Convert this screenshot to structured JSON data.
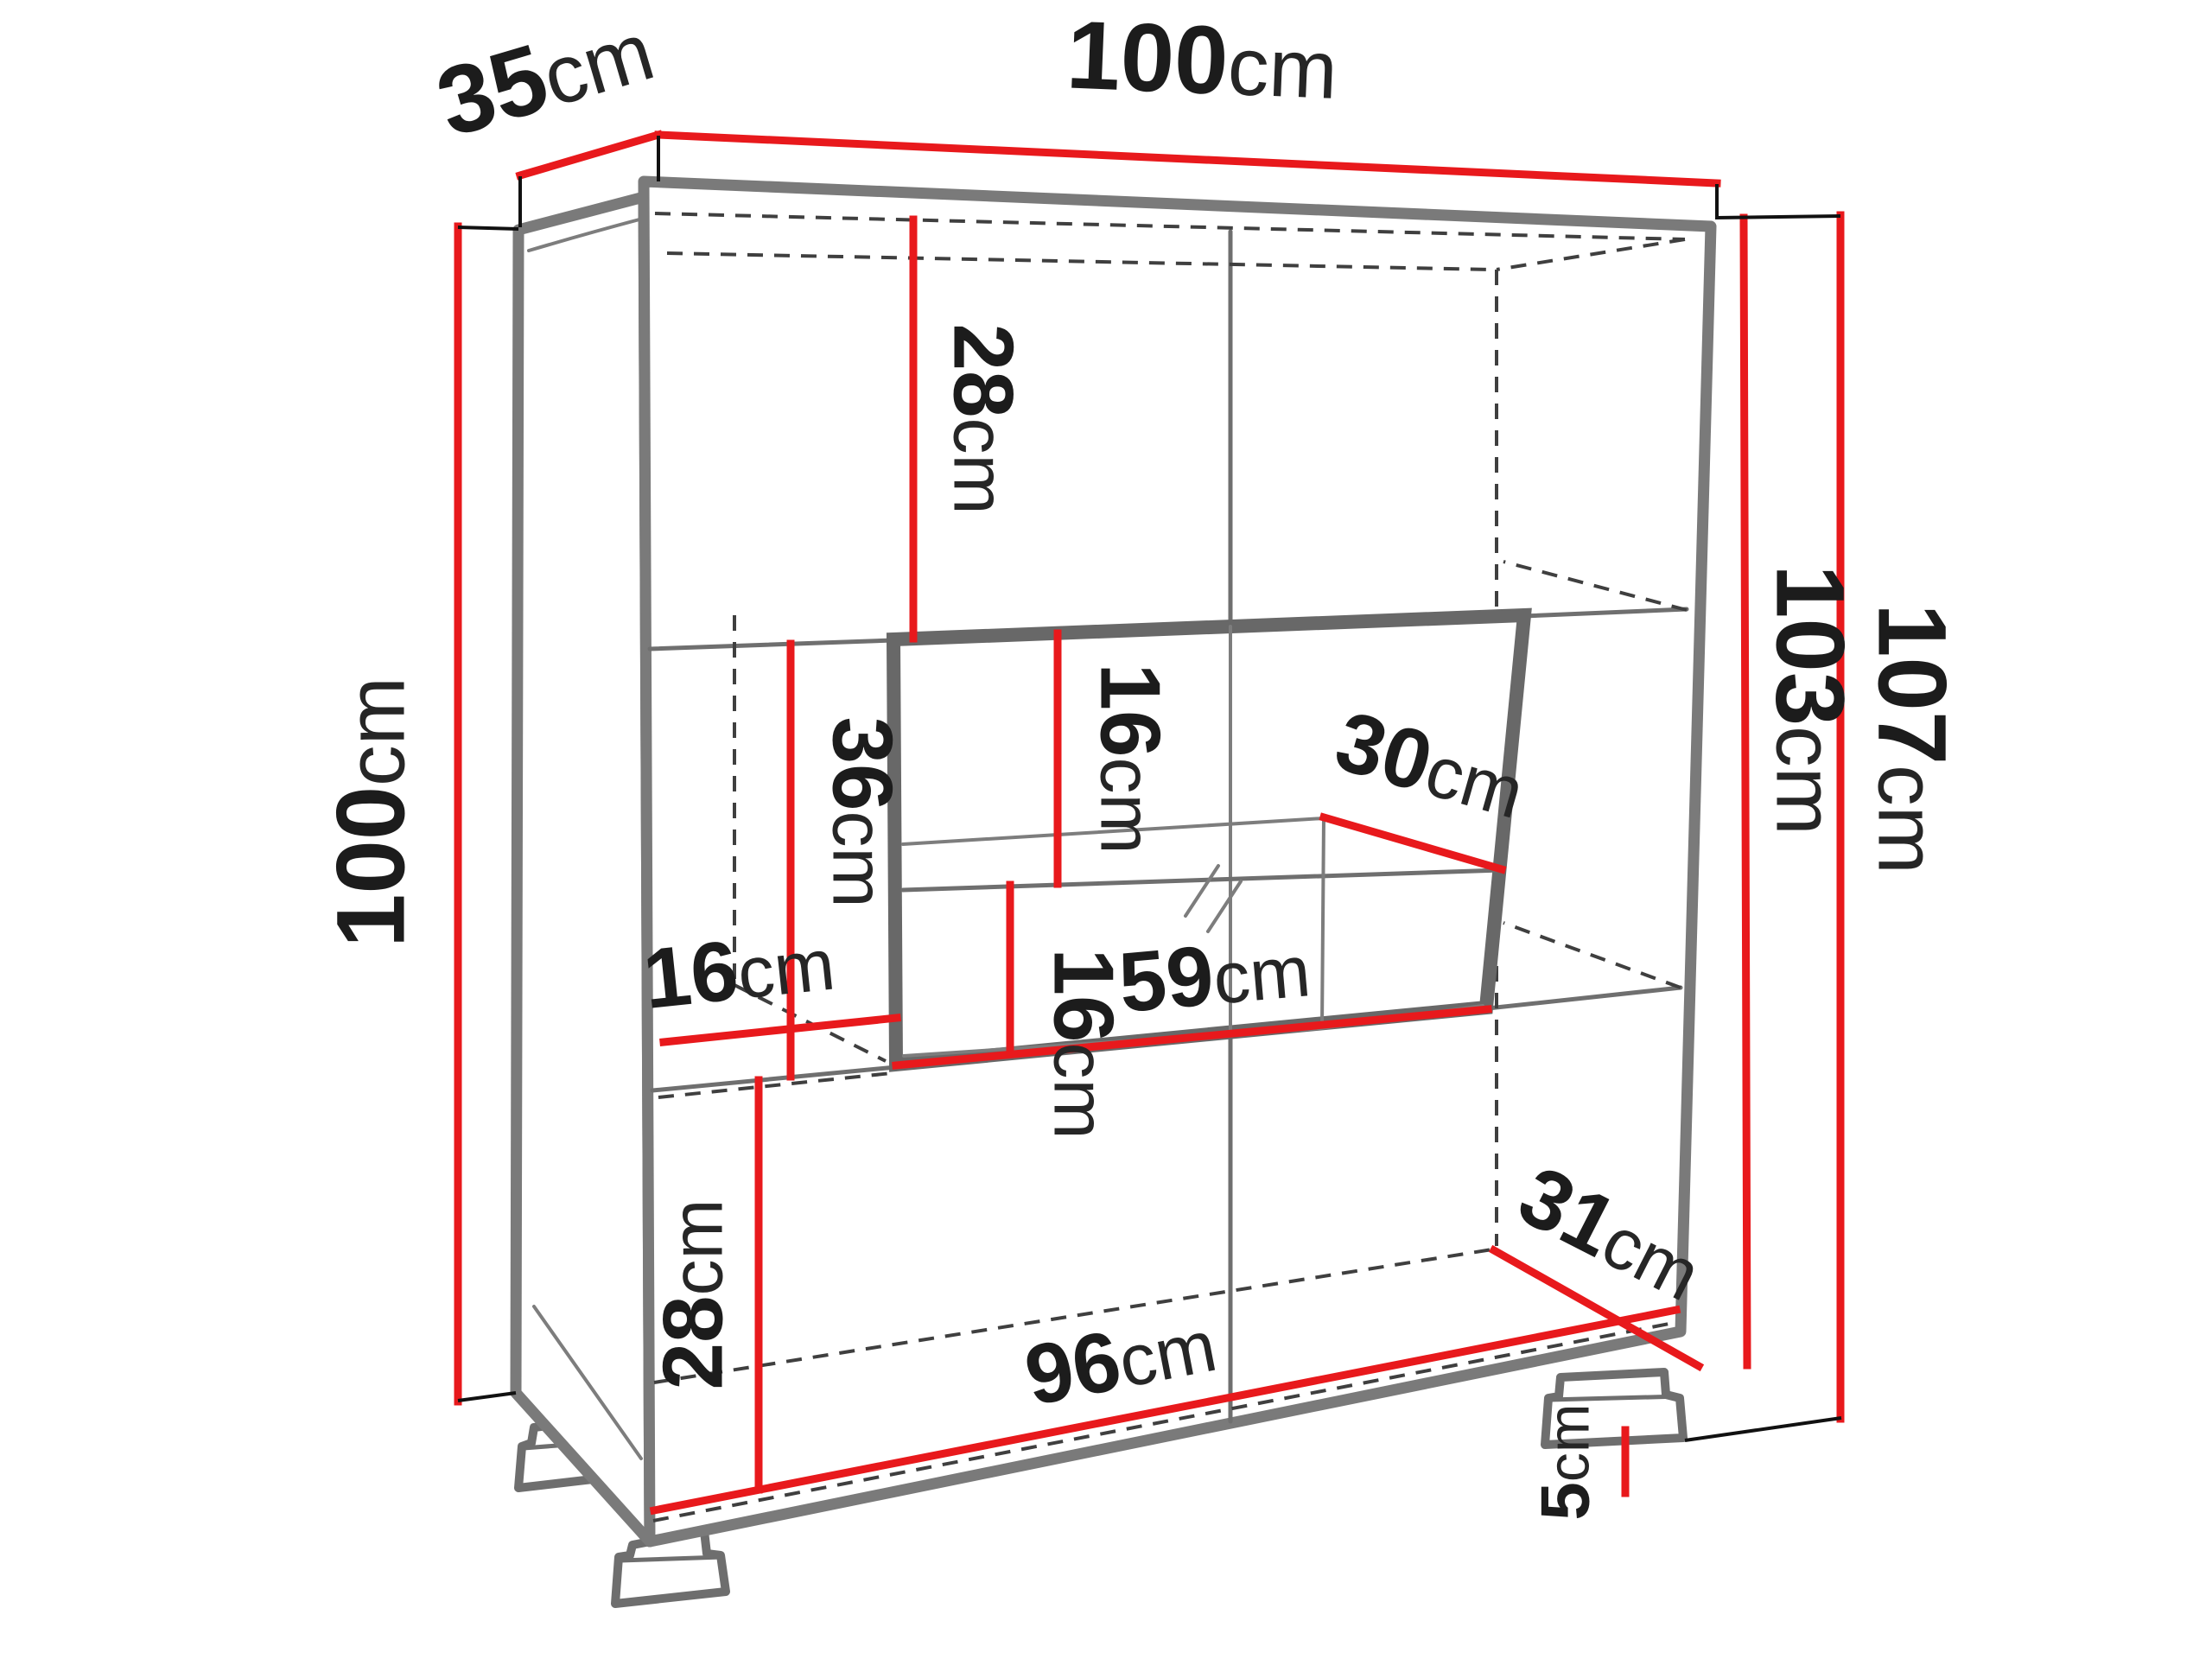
{
  "drawing": {
    "object": "display-cabinet-dimension-diagram",
    "unit": "cm",
    "dimensions": {
      "depth_top": {
        "value": "35",
        "unit": "cm"
      },
      "width_top": {
        "value": "100",
        "unit": "cm"
      },
      "height_left": {
        "value": "100",
        "unit": "cm"
      },
      "height_inner_right": {
        "value": "103",
        "unit": "cm"
      },
      "height_total_right": {
        "value": "107",
        "unit": "cm"
      },
      "top_section_height": {
        "value": "28",
        "unit": "cm"
      },
      "display_upper_height": {
        "value": "16",
        "unit": "cm"
      },
      "display_shelf_depth": {
        "value": "30",
        "unit": "cm"
      },
      "display_lower_height": {
        "value": "16",
        "unit": "cm"
      },
      "middle_left_height": {
        "value": "36",
        "unit": "cm"
      },
      "left_column_width": {
        "value": "16",
        "unit": "cm"
      },
      "display_width": {
        "value": "59",
        "unit": "cm"
      },
      "bottom_section_height": {
        "value": "28",
        "unit": "cm"
      },
      "bottom_depth_right": {
        "value": "31",
        "unit": "cm"
      },
      "bottom_width": {
        "value": "96",
        "unit": "cm"
      },
      "foot_height": {
        "value": "5",
        "unit": "cm"
      }
    }
  },
  "colors": {
    "dimension_line": "#e8191c",
    "edge": "#7a7a7a",
    "edge_dark": "#686868",
    "hidden_line": "#3f3f3f",
    "text": "#1c1c1c",
    "background": "#ffffff"
  }
}
